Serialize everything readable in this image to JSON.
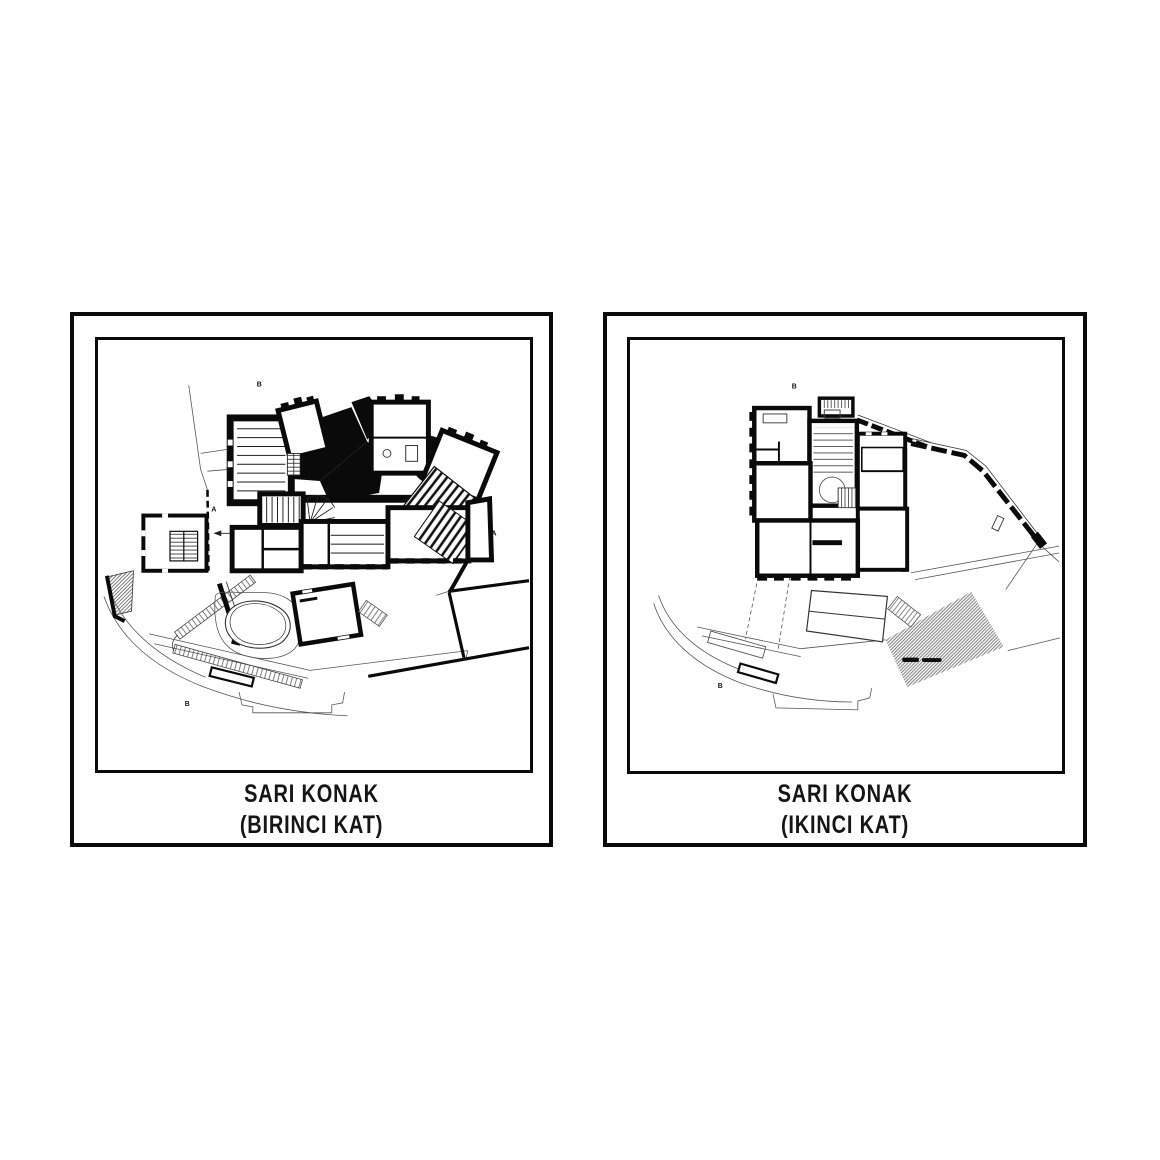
{
  "sheet": {
    "background": "#ffffff",
    "ink": "#0a0a0a"
  },
  "panels": [
    {
      "name": "left",
      "caption_line1": "SARI KONAK",
      "caption_line2": "(BIRINCI KAT)",
      "markers": {
        "top": "B",
        "left": "A",
        "right": "A",
        "bottom": "B"
      }
    },
    {
      "name": "right",
      "caption_line1": "SARI KONAK",
      "caption_line2": "(IKINCI KAT)",
      "markers": {
        "top": "B",
        "bottom": "B"
      }
    }
  ]
}
